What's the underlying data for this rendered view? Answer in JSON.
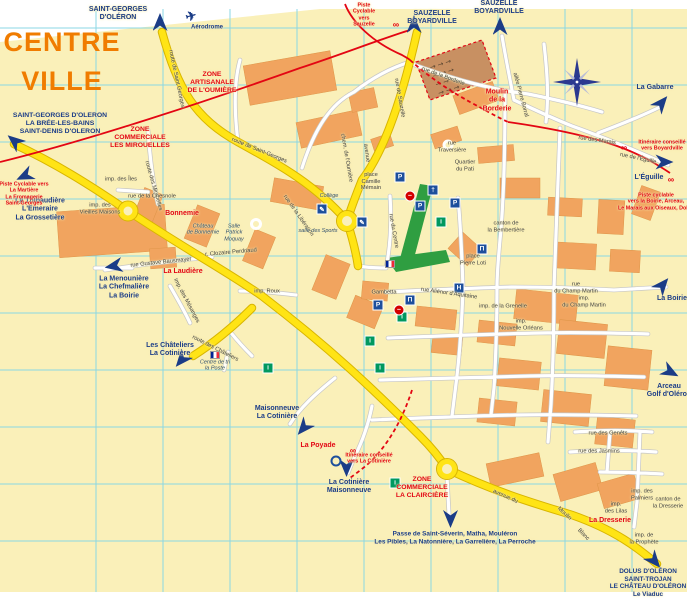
{
  "title": {
    "line1": "CENTRE",
    "line2": "VILLE"
  },
  "colors": {
    "cream": "#FAF0B9",
    "grid": "#8BD7E4",
    "road_yellow": "#FFE415",
    "road_casing": "#D8B500",
    "building": "#F1A45F",
    "market": "#C89062",
    "park": "#2F9E41",
    "cycle_red": "#E30613",
    "label_navy": "#1B3C87",
    "zone_red": "#E30613",
    "title_orange": "#F07C00"
  },
  "icon_glyphs": {
    "plane": "✈",
    "parking": "P",
    "church": "†",
    "museum": "Π",
    "hotel": "H",
    "info": "i",
    "school": "✎",
    "noentry": "–",
    "bike": "∞",
    "flag": "",
    "ring": ""
  },
  "labels": [
    {
      "cls": "dest",
      "x": 118,
      "y": 14,
      "lines": [
        "SAINT-GEORGES",
        "D'OLÉRON"
      ]
    },
    {
      "cls": "dest",
      "x": 207,
      "y": 28,
      "fs": 6,
      "lines": [
        "Aérodrome"
      ]
    },
    {
      "cls": "dest",
      "x": 432,
      "y": 18,
      "lines": [
        "SAUZELLE",
        "BOYARDVILLE"
      ]
    },
    {
      "cls": "dest",
      "x": 499,
      "y": 8,
      "lines": [
        "SAUZELLE",
        "BOYARDVILLE"
      ]
    },
    {
      "cls": "dest",
      "x": 655,
      "y": 88,
      "lines": [
        "La Gabarre"
      ]
    },
    {
      "cls": "dest",
      "x": 60,
      "y": 124,
      "fs": 6.8,
      "lines": [
        "SAINT-GEORGES D'OLERON",
        "LA BRÉE-LES-BAINS",
        "SAINT-DENIS D'OLERON"
      ]
    },
    {
      "cls": "dest",
      "x": 40,
      "y": 210,
      "lines": [
        "La Thibaudière",
        "L'Emeraire",
        "La Grossetière"
      ]
    },
    {
      "cls": "dest",
      "x": 124,
      "y": 288,
      "lines": [
        "La Menounière",
        "La Chefmalière",
        "La Boirie"
      ]
    },
    {
      "cls": "dest",
      "x": 170,
      "y": 350,
      "lines": [
        "Les Châteliers",
        "La Cotinière"
      ]
    },
    {
      "cls": "dest",
      "x": 277,
      "y": 413,
      "lines": [
        "Maisonneuve",
        "La Cotinière"
      ]
    },
    {
      "cls": "dest",
      "x": 349,
      "y": 487,
      "lines": [
        "La Cotinière",
        "Maisonneuve"
      ]
    },
    {
      "cls": "dest",
      "x": 455,
      "y": 538,
      "fs": 6.4,
      "lines": [
        "Passe de Saint-Séverin, Matha, Mouléron",
        "Les Pibles, La Natonnière, La Garrelière, La Perroche"
      ]
    },
    {
      "cls": "dest",
      "x": 648,
      "y": 583,
      "fs": 6.4,
      "lines": [
        "DOLUS D'OLÉRON",
        "SAINT-TROJAN",
        "LE CHÂTEAU D'OLÉRON",
        "Le Viaduc"
      ]
    },
    {
      "cls": "dest",
      "x": 649,
      "y": 178,
      "lines": [
        "L'Éguille"
      ]
    },
    {
      "cls": "dest",
      "x": 672,
      "y": 299,
      "lines": [
        "La Boirie"
      ]
    },
    {
      "cls": "dest",
      "x": 669,
      "y": 391,
      "lines": [
        "Arceau",
        "Golf d'Oléron"
      ]
    },
    {
      "cls": "zone",
      "x": 212,
      "y": 83,
      "lines": [
        "ZONE",
        "ARTISANALE",
        "DE L'OUMIÈRE"
      ]
    },
    {
      "cls": "zone",
      "x": 140,
      "y": 138,
      "lines": [
        "ZONE",
        "COMMERCIALE",
        "LES MIROUELLES"
      ]
    },
    {
      "cls": "zone",
      "x": 422,
      "y": 488,
      "lines": [
        "ZONE",
        "COMMERCIALE",
        "LA CLAIRCIÈRE"
      ]
    },
    {
      "cls": "place",
      "x": 182,
      "y": 214,
      "lines": [
        "Bonnemie"
      ]
    },
    {
      "cls": "place",
      "x": 183,
      "y": 272,
      "lines": [
        "La Laudière"
      ]
    },
    {
      "cls": "place",
      "x": 318,
      "y": 446,
      "lines": [
        "La Poyade"
      ]
    },
    {
      "cls": "place",
      "x": 610,
      "y": 521,
      "lines": [
        "La Dresserie"
      ]
    },
    {
      "cls": "place",
      "x": 497,
      "y": 101,
      "lines": [
        "Moulin",
        "de la",
        "Borderie"
      ]
    },
    {
      "cls": "info",
      "x": 364,
      "y": 15,
      "lines": [
        "Piste",
        "Cyclable",
        "vers",
        "Sauzelle"
      ]
    },
    {
      "cls": "info",
      "x": 24,
      "y": 194,
      "lines": [
        "Piste Cyclable vers",
        "La Martière",
        "La Fromagerie",
        "Saint-Georges"
      ]
    },
    {
      "cls": "info",
      "x": 662,
      "y": 146,
      "lines": [
        "Itinéraire conseillé",
        "vers Boyardville"
      ]
    },
    {
      "cls": "info",
      "x": 656,
      "y": 202,
      "lines": [
        "Piste cyclable",
        "vers la Boirie, Arceau,",
        "Le Marais aux Oiseaux, Dolus"
      ]
    },
    {
      "cls": "info",
      "x": 369,
      "y": 459,
      "lines": [
        "Itinéraire conseillé",
        "vers La Cotinière"
      ]
    },
    {
      "cls": "street",
      "x": 176,
      "y": 79,
      "rot": 78,
      "lines": [
        "route de Saint Georges"
      ]
    },
    {
      "cls": "street",
      "x": 259,
      "y": 151,
      "rot": 22,
      "lines": [
        "route de Saint-Georges"
      ]
    },
    {
      "cls": "street",
      "x": 399,
      "y": 98,
      "rot": 80,
      "lines": [
        "rue de Sauzelle"
      ]
    },
    {
      "cls": "street",
      "x": 443,
      "y": 77,
      "rot": 20,
      "lines": [
        "rue de la Borderie"
      ]
    },
    {
      "cls": "street",
      "x": 366,
      "y": 153,
      "rot": 82,
      "lines": [
        "avenue"
      ]
    },
    {
      "cls": "street",
      "x": 298,
      "y": 216,
      "rot": 55,
      "lines": [
        "rue de la Libération"
      ]
    },
    {
      "cls": "street",
      "x": 153,
      "y": 186,
      "rot": 74,
      "lines": [
        "route des Mirouelles"
      ]
    },
    {
      "cls": "street",
      "x": 121,
      "y": 180,
      "lines": [
        "imp. des Îles"
      ]
    },
    {
      "cls": "street",
      "x": 152,
      "y": 197,
      "lines": [
        "rue de la Chesnole"
      ]
    },
    {
      "cls": "street",
      "x": 100,
      "y": 209,
      "lines": [
        "imp. des",
        "Vieilles Maisons"
      ]
    },
    {
      "cls": "street",
      "x": 161,
      "y": 263,
      "rot": -6,
      "lines": [
        "rue Gustave Bausmayer"
      ]
    },
    {
      "cls": "street",
      "x": 186,
      "y": 301,
      "rot": 62,
      "lines": [
        "imp. des Mésanges"
      ]
    },
    {
      "cls": "street",
      "x": 267,
      "y": 292,
      "lines": [
        "imp. Roux"
      ]
    },
    {
      "cls": "street",
      "x": 231,
      "y": 253,
      "rot": -5,
      "lines": [
        "r. Clozaire Perdriaud"
      ]
    },
    {
      "cls": "venue",
      "x": 203,
      "y": 230,
      "lines": [
        "Château",
        "de Bonnemie"
      ]
    },
    {
      "cls": "venue",
      "x": 234,
      "y": 233,
      "lines": [
        "Salle",
        "Patrick",
        "Moquay"
      ]
    },
    {
      "cls": "street",
      "x": 215,
      "y": 349,
      "rot": 27,
      "lines": [
        "route des Châteliers"
      ]
    },
    {
      "cls": "venue",
      "x": 215,
      "y": 366,
      "lines": [
        "Centre de tri",
        "la Poste"
      ]
    },
    {
      "cls": "street",
      "x": 371,
      "y": 182,
      "lines": [
        "place",
        "Camille",
        "Mémain"
      ]
    },
    {
      "cls": "venue",
      "x": 329,
      "y": 196,
      "lines": [
        "Collège"
      ]
    },
    {
      "cls": "street",
      "x": 473,
      "y": 260,
      "lines": [
        "place",
        "Pierre Loti"
      ]
    },
    {
      "cls": "street",
      "x": 506,
      "y": 227,
      "lines": [
        "canton de",
        "la Bembertière"
      ]
    },
    {
      "cls": "street",
      "x": 384,
      "y": 293,
      "lines": [
        "Gambetta"
      ]
    },
    {
      "cls": "street",
      "x": 449,
      "y": 294,
      "rot": 8,
      "lines": [
        "rue Aliénor d'Aquitaine"
      ]
    },
    {
      "cls": "street",
      "x": 393,
      "y": 231,
      "rot": 80,
      "lines": [
        "rue du Centre"
      ]
    },
    {
      "cls": "street",
      "x": 576,
      "y": 288,
      "lines": [
        "rue",
        "du Champ Martin"
      ]
    },
    {
      "cls": "street",
      "x": 584,
      "y": 302,
      "lines": [
        "imp.",
        "du Champ Martin"
      ]
    },
    {
      "cls": "street",
      "x": 503,
      "y": 307,
      "lines": [
        "imp. de la Grenelle"
      ]
    },
    {
      "cls": "street",
      "x": 521,
      "y": 325,
      "lines": [
        "imp.",
        "Nouvelle Orléans"
      ]
    },
    {
      "cls": "street",
      "x": 608,
      "y": 434,
      "lines": [
        "rue des Genêts"
      ]
    },
    {
      "cls": "street",
      "x": 599,
      "y": 452,
      "lines": [
        "rue des Jasmins"
      ]
    },
    {
      "cls": "street",
      "x": 642,
      "y": 495,
      "lines": [
        "imp. des",
        "Palmiers"
      ]
    },
    {
      "cls": "street",
      "x": 668,
      "y": 503,
      "lines": [
        "canton de",
        "la Dresserie"
      ]
    },
    {
      "cls": "street",
      "x": 616,
      "y": 508,
      "lines": [
        "imp.",
        "des Lilas"
      ]
    },
    {
      "cls": "street",
      "x": 644,
      "y": 539,
      "lines": [
        "imp. de",
        "la Prophète"
      ]
    },
    {
      "cls": "street",
      "x": 505,
      "y": 497,
      "rot": 24,
      "lines": [
        "avenue du"
      ]
    },
    {
      "cls": "street",
      "x": 564,
      "y": 514,
      "rot": 42,
      "lines": [
        "Moulin"
      ]
    },
    {
      "cls": "street",
      "x": 583,
      "y": 535,
      "rot": 46,
      "lines": [
        "Blanc"
      ]
    },
    {
      "cls": "street",
      "x": 638,
      "y": 159,
      "rot": 12,
      "lines": [
        "rue de l'Éguille"
      ]
    },
    {
      "cls": "street",
      "x": 597,
      "y": 141,
      "rot": 8,
      "lines": [
        "rue des Marais"
      ]
    },
    {
      "cls": "street",
      "x": 520,
      "y": 95,
      "rot": 75,
      "lines": [
        "allée Pierre Borral"
      ]
    },
    {
      "cls": "street",
      "x": 346,
      "y": 158,
      "rot": 80,
      "lines": [
        "chem. de l'Oumière"
      ]
    },
    {
      "cls": "street",
      "x": 465,
      "y": 166,
      "lines": [
        "Quartier",
        "du Pati"
      ]
    },
    {
      "cls": "street",
      "x": 452,
      "y": 147,
      "lines": [
        "rue",
        "Traversière"
      ]
    },
    {
      "cls": "venue",
      "x": 318,
      "y": 231,
      "lines": [
        "salle des Sports"
      ]
    }
  ],
  "arrows": [
    {
      "x": 160,
      "y": 22,
      "deg": 0
    },
    {
      "x": 414,
      "y": 24,
      "deg": 0
    },
    {
      "x": 500,
      "y": 26,
      "deg": 0
    },
    {
      "x": 661,
      "y": 103,
      "deg": 40
    },
    {
      "x": 14,
      "y": 141,
      "deg": -50
    },
    {
      "x": 24,
      "y": 176,
      "deg": -115
    },
    {
      "x": 113,
      "y": 266,
      "deg": -100
    },
    {
      "x": 181,
      "y": 360,
      "deg": -140
    },
    {
      "x": 303,
      "y": 428,
      "deg": -140
    },
    {
      "x": 346,
      "y": 468,
      "deg": 180
    },
    {
      "x": 450,
      "y": 519,
      "deg": 180
    },
    {
      "x": 654,
      "y": 561,
      "deg": 140
    },
    {
      "x": 664,
      "y": 162,
      "deg": 90
    },
    {
      "x": 662,
      "y": 285,
      "deg": 40
    },
    {
      "x": 670,
      "y": 372,
      "deg": 118
    }
  ],
  "icons": [
    {
      "kind": "plane",
      "x": 191,
      "y": 16,
      "rot": -15
    },
    {
      "kind": "flag",
      "x": 390,
      "y": 264
    },
    {
      "kind": "flag",
      "x": 215,
      "y": 355
    },
    {
      "kind": "parking",
      "x": 400,
      "y": 177
    },
    {
      "kind": "parking",
      "x": 420,
      "y": 206
    },
    {
      "kind": "parking",
      "x": 455,
      "y": 203
    },
    {
      "kind": "parking",
      "x": 378,
      "y": 305
    },
    {
      "kind": "church",
      "x": 433,
      "y": 190
    },
    {
      "kind": "museum",
      "x": 482,
      "y": 249
    },
    {
      "kind": "museum",
      "x": 410,
      "y": 300
    },
    {
      "kind": "hotel",
      "x": 459,
      "y": 288
    },
    {
      "kind": "info",
      "x": 441,
      "y": 222
    },
    {
      "kind": "info",
      "x": 395,
      "y": 483
    },
    {
      "kind": "info",
      "x": 402,
      "y": 317
    },
    {
      "kind": "info",
      "x": 370,
      "y": 341
    },
    {
      "kind": "info",
      "x": 380,
      "y": 368
    },
    {
      "kind": "info",
      "x": 268,
      "y": 368
    },
    {
      "kind": "school",
      "x": 322,
      "y": 209
    },
    {
      "kind": "school",
      "x": 362,
      "y": 222
    },
    {
      "kind": "noentry",
      "x": 410,
      "y": 196
    },
    {
      "kind": "noentry",
      "x": 399,
      "y": 310
    },
    {
      "kind": "bike",
      "x": 396,
      "y": 24
    },
    {
      "kind": "bike",
      "x": 624,
      "y": 147
    },
    {
      "kind": "bike",
      "x": 671,
      "y": 179
    },
    {
      "kind": "bike",
      "x": 353,
      "y": 450
    },
    {
      "kind": "ring",
      "x": 336,
      "y": 461
    }
  ]
}
